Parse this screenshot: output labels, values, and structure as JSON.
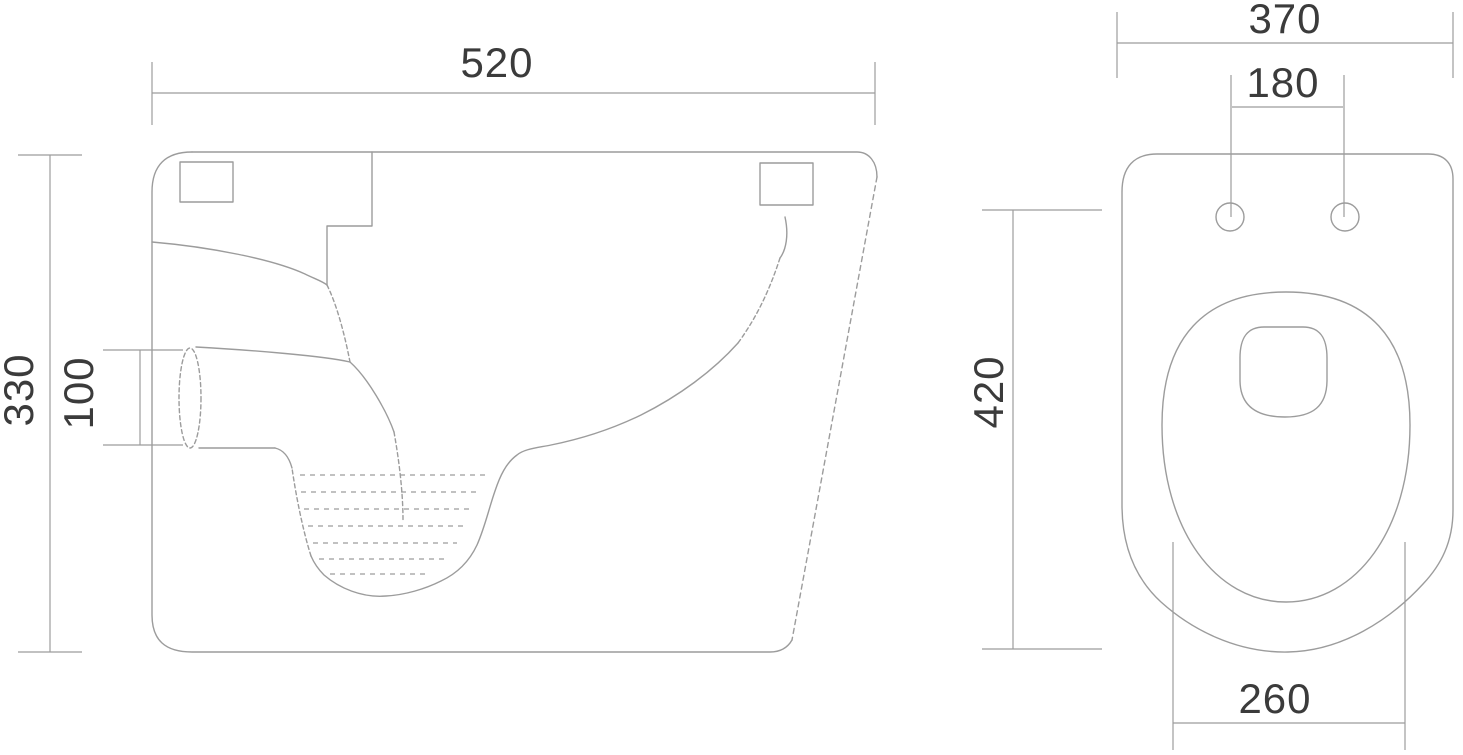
{
  "colors": {
    "line": "#9c9c9c",
    "text": "#3b3b3b",
    "background": "#ffffff"
  },
  "side_view": {
    "dimensions": {
      "overall_width": "520",
      "overall_height": "330",
      "outlet_diameter": "100"
    }
  },
  "top_view": {
    "dimensions": {
      "overall_width": "370",
      "fixing_holes_spacing": "180",
      "overall_depth": "420",
      "bowl_front_width": "260"
    }
  }
}
